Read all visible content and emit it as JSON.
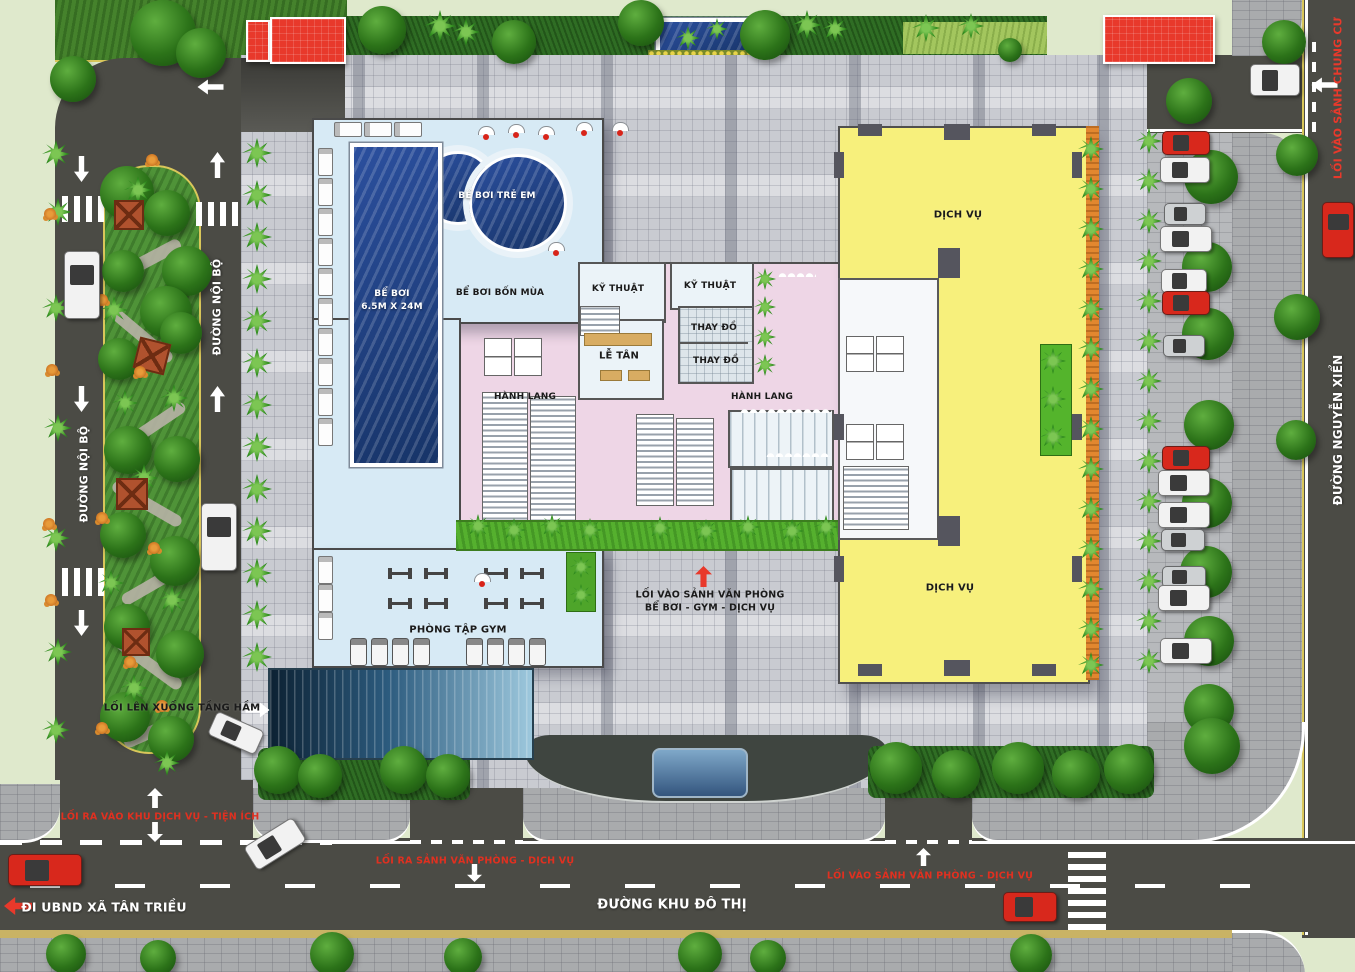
{
  "app": {
    "type": "architectural-master-site-plan",
    "project": "Tòa nhà hỗn hợp - mặt bằng tầng 1"
  },
  "colors": {
    "accent_red": "#e8392b",
    "road": "#4b4b45",
    "plaza": "#c9cbd1",
    "pool_water": "#1f3f85",
    "pool_hall": "#d7eaf5",
    "corridor_pink": "#eed6e6",
    "service_yellow": "#f7f07c",
    "green_strip": "#55b02e",
    "orange_band": "#e2872f",
    "cars": {
      "white": "#f2f2f2",
      "red": "#d8281c",
      "silver": "#ced1d3"
    }
  },
  "labels": {
    "pool_kids": "BỂ BƠI TRẺ EM",
    "pool_main_1": "BỂ BƠI",
    "pool_main_2": "6.5M X 24M",
    "pool_four_season": "BỂ BƠI BỐN MÙA",
    "technical_1": "KỸ THUẬT",
    "technical_2": "KỸ THUẬT",
    "changing_1": "THAY ĐỒ",
    "changing_2": "THAY ĐỒ",
    "reception": "LỄ TÂN",
    "corridor_1": "HÀNH LANG",
    "corridor_2": "HÀNH LANG",
    "service_1": "DỊCH VỤ",
    "service_2": "DỊCH VỤ",
    "gym": "PHÒNG TẬP GYM",
    "basement_ramp": "LỐI LÊN XUỐNG TẦNG HẦM",
    "office_entry_1": "LỐI VÀO SẢNH VĂN PHÒNG",
    "office_entry_2": "BỂ BƠI - GYM - DỊCH VỤ",
    "to_ubnd": "ĐI UBND XÃ TÂN TRIỀU",
    "urban_road": "ĐƯỜNG KHU ĐÔ THỊ",
    "internal_road_1": "ĐƯỜNG NỘI BỘ",
    "internal_road_2": "ĐƯỜNG NỘI BỘ",
    "nguyen_xien": "ĐƯỜNG NGUYỄN XIỂN",
    "apartment_entry": "LỐI VÀO SẢNH CHUNG CƯ",
    "service_gate": "LỐI RA VÀO KHU DỊCH VỤ - TIỆN ÍCH",
    "office_exit": "LỐI RA SẢNH VĂN PHÒNG - DỊCH VỤ",
    "office_gate": "LỐI VÀO SẢNH VĂN PHÒNG - DỊCH VỤ"
  },
  "decor": {
    "trees_round": [
      [
        130,
        0,
        66
      ],
      [
        176,
        28,
        50
      ],
      [
        50,
        56,
        46
      ],
      [
        358,
        6,
        48
      ],
      [
        492,
        20,
        44
      ],
      [
        618,
        0,
        46
      ],
      [
        740,
        10,
        50
      ],
      [
        998,
        38,
        24
      ],
      [
        1166,
        78,
        46
      ],
      [
        1262,
        20,
        44
      ],
      [
        1276,
        134,
        42
      ],
      [
        1274,
        294,
        46
      ],
      [
        1276,
        420,
        40
      ],
      [
        1184,
        150,
        54
      ],
      [
        1182,
        242,
        50
      ],
      [
        1182,
        308,
        52
      ],
      [
        1184,
        400,
        50
      ],
      [
        1182,
        478,
        50
      ],
      [
        1180,
        546,
        52
      ],
      [
        1184,
        616,
        50
      ],
      [
        1184,
        684,
        50
      ],
      [
        1184,
        718,
        56
      ],
      [
        870,
        742,
        52
      ],
      [
        932,
        750,
        48
      ],
      [
        992,
        742,
        52
      ],
      [
        1052,
        750,
        48
      ],
      [
        1104,
        744,
        50
      ],
      [
        254,
        746,
        48
      ],
      [
        298,
        754,
        44
      ],
      [
        380,
        746,
        48
      ],
      [
        426,
        754,
        44
      ],
      [
        46,
        934,
        40
      ],
      [
        140,
        940,
        36
      ],
      [
        310,
        932,
        44
      ],
      [
        444,
        938,
        38
      ],
      [
        678,
        932,
        44
      ],
      [
        750,
        940,
        36
      ],
      [
        1010,
        934,
        42
      ],
      [
        100,
        166,
        54
      ],
      [
        144,
        190,
        46
      ],
      [
        162,
        246,
        50
      ],
      [
        102,
        250,
        42
      ],
      [
        140,
        286,
        52
      ],
      [
        98,
        338,
        42
      ],
      [
        160,
        312,
        42
      ],
      [
        104,
        426,
        48
      ],
      [
        154,
        436,
        46
      ],
      [
        100,
        512,
        46
      ],
      [
        150,
        536,
        50
      ],
      [
        104,
        604,
        46
      ],
      [
        156,
        630,
        48
      ],
      [
        100,
        692,
        50
      ],
      [
        148,
        716,
        46
      ]
    ],
    "trees_palm": [
      [
        42,
        140,
        28
      ],
      [
        44,
        198,
        28
      ],
      [
        42,
        294,
        28
      ],
      [
        44,
        414,
        28
      ],
      [
        42,
        524,
        28
      ],
      [
        44,
        638,
        28
      ],
      [
        42,
        716,
        28
      ],
      [
        424,
        10,
        32
      ],
      [
        452,
        18,
        28
      ],
      [
        792,
        10,
        30
      ],
      [
        822,
        16,
        26
      ],
      [
        912,
        14,
        28
      ],
      [
        958,
        13,
        26
      ],
      [
        676,
        26,
        24
      ],
      [
        706,
        18,
        22
      ],
      [
        124,
        176,
        28
      ],
      [
        100,
        296,
        28
      ],
      [
        160,
        384,
        28
      ],
      [
        112,
        390,
        26
      ],
      [
        130,
        464,
        28
      ],
      [
        98,
        570,
        26
      ],
      [
        158,
        586,
        28
      ],
      [
        120,
        674,
        28
      ],
      [
        154,
        750,
        26
      ],
      [
        242,
        138,
        30
      ],
      [
        242,
        180,
        30
      ],
      [
        242,
        222,
        30
      ],
      [
        242,
        264,
        30
      ],
      [
        242,
        306,
        30
      ],
      [
        242,
        348,
        30
      ],
      [
        242,
        390,
        30
      ],
      [
        242,
        432,
        30
      ],
      [
        242,
        474,
        30
      ],
      [
        242,
        516,
        30
      ],
      [
        242,
        558,
        30
      ],
      [
        242,
        600,
        30
      ],
      [
        242,
        642,
        30
      ],
      [
        1078,
        136,
        26
      ],
      [
        1078,
        176,
        26
      ],
      [
        1078,
        216,
        26
      ],
      [
        1078,
        256,
        26
      ],
      [
        1078,
        296,
        26
      ],
      [
        1078,
        336,
        26
      ],
      [
        1078,
        376,
        26
      ],
      [
        1078,
        416,
        26
      ],
      [
        1078,
        456,
        26
      ],
      [
        1078,
        496,
        26
      ],
      [
        1078,
        536,
        26
      ],
      [
        1078,
        576,
        26
      ],
      [
        1078,
        616,
        26
      ],
      [
        1078,
        652,
        26
      ],
      [
        1136,
        128,
        26
      ],
      [
        1136,
        168,
        26
      ],
      [
        1136,
        208,
        26
      ],
      [
        1136,
        248,
        26
      ],
      [
        1136,
        288,
        26
      ],
      [
        1136,
        328,
        26
      ],
      [
        1136,
        368,
        26
      ],
      [
        1136,
        408,
        26
      ],
      [
        1136,
        448,
        26
      ],
      [
        1136,
        488,
        26
      ],
      [
        1136,
        528,
        26
      ],
      [
        1136,
        568,
        26
      ],
      [
        1136,
        608,
        26
      ],
      [
        1136,
        648,
        26
      ],
      [
        466,
        514,
        24
      ],
      [
        502,
        518,
        24
      ],
      [
        540,
        514,
        24
      ],
      [
        578,
        518,
        24
      ],
      [
        648,
        516,
        24
      ],
      [
        694,
        519,
        24
      ],
      [
        736,
        515,
        24
      ],
      [
        780,
        519,
        24
      ],
      [
        814,
        515,
        24
      ],
      [
        570,
        556,
        22
      ],
      [
        570,
        584,
        22
      ],
      [
        754,
        268,
        22
      ],
      [
        754,
        296,
        22
      ],
      [
        754,
        326,
        22
      ],
      [
        754,
        354,
        22
      ],
      [
        1040,
        348,
        26
      ],
      [
        1040,
        386,
        26
      ],
      [
        1040,
        424,
        26
      ]
    ],
    "cars": [
      [
        64,
        251,
        34,
        66,
        "white",
        0
      ],
      [
        201,
        503,
        34,
        66,
        "white",
        0
      ],
      [
        1250,
        64,
        48,
        30,
        "white",
        0
      ],
      [
        1322,
        202,
        30,
        54,
        "red",
        0
      ],
      [
        8,
        854,
        72,
        30,
        "red",
        0
      ],
      [
        246,
        830,
        56,
        26,
        "white",
        -32
      ],
      [
        1003,
        892,
        52,
        28,
        "red",
        0
      ],
      [
        210,
        720,
        50,
        24,
        "white",
        24
      ],
      [
        1162,
        131,
        46,
        22,
        "red",
        0
      ],
      [
        1160,
        157,
        48,
        24,
        "white",
        0
      ],
      [
        1164,
        203,
        40,
        20,
        "silver",
        0
      ],
      [
        1160,
        226,
        50,
        24,
        "white",
        0
      ],
      [
        1161,
        269,
        44,
        22,
        "white",
        0
      ],
      [
        1162,
        291,
        46,
        22,
        "red",
        0
      ],
      [
        1163,
        335,
        40,
        20,
        "silver",
        0
      ],
      [
        1162,
        446,
        46,
        22,
        "red",
        0
      ],
      [
        1158,
        470,
        50,
        24,
        "white",
        0
      ],
      [
        1158,
        502,
        50,
        24,
        "white",
        0
      ],
      [
        1161,
        529,
        42,
        20,
        "silver",
        0
      ],
      [
        1162,
        566,
        42,
        20,
        "silver",
        0
      ],
      [
        1158,
        585,
        50,
        24,
        "white",
        0
      ],
      [
        1160,
        638,
        50,
        24,
        "white",
        0
      ]
    ],
    "crosswalks": [
      [
        62,
        196,
        46,
        26,
        "v"
      ],
      [
        196,
        202,
        46,
        24,
        "v"
      ],
      [
        62,
        568,
        46,
        28,
        "v"
      ],
      [
        1068,
        846,
        38,
        84,
        "h"
      ]
    ],
    "arrows": [
      [
        210,
        152,
        15,
        26,
        0,
        "w"
      ],
      [
        210,
        386,
        15,
        26,
        0,
        "w"
      ],
      [
        74,
        156,
        15,
        26,
        180,
        "w"
      ],
      [
        74,
        386,
        15,
        26,
        180,
        "w"
      ],
      [
        74,
        610,
        15,
        26,
        180,
        "w"
      ],
      [
        147,
        788,
        16,
        20,
        0,
        "w"
      ],
      [
        147,
        822,
        16,
        20,
        180,
        "w"
      ],
      [
        467,
        864,
        15,
        18,
        180,
        "w"
      ],
      [
        916,
        848,
        15,
        18,
        0,
        "w"
      ],
      [
        695,
        566,
        17,
        21,
        0,
        "r"
      ],
      [
        203,
        74,
        15,
        26,
        270,
        "w"
      ],
      [
        1317,
        72,
        15,
        26,
        270,
        "w"
      ],
      [
        9,
        892,
        18,
        28,
        270,
        "r"
      ],
      [
        250,
        698,
        15,
        24,
        90,
        "w"
      ]
    ],
    "gazebos": [
      [
        114,
        200,
        26,
        0
      ],
      [
        136,
        340,
        28,
        14
      ],
      [
        116,
        478,
        28,
        0
      ],
      [
        122,
        628,
        24,
        0
      ]
    ],
    "flowers": [
      [
        44,
        208
      ],
      [
        46,
        364
      ],
      [
        43,
        518
      ],
      [
        45,
        594
      ],
      [
        146,
        154
      ],
      [
        96,
        294
      ],
      [
        134,
        366
      ],
      [
        96,
        512
      ],
      [
        148,
        542
      ],
      [
        124,
        656
      ],
      [
        96,
        722
      ],
      [
        156,
        700
      ]
    ],
    "umbrellas": [
      [
        478,
        126
      ],
      [
        508,
        124
      ],
      [
        538,
        126
      ],
      [
        576,
        122
      ],
      [
        612,
        122
      ],
      [
        548,
        242
      ],
      [
        474,
        573
      ]
    ],
    "loungers_v": [
      [
        318,
        148
      ],
      [
        318,
        178
      ],
      [
        318,
        208
      ],
      [
        318,
        238
      ],
      [
        318,
        268
      ],
      [
        318,
        298
      ],
      [
        318,
        328
      ],
      [
        318,
        358
      ],
      [
        318,
        388
      ],
      [
        318,
        418
      ],
      [
        318,
        556
      ],
      [
        318,
        584
      ],
      [
        318,
        612
      ]
    ],
    "loungers_h": [
      [
        334,
        122
      ],
      [
        364,
        122
      ],
      [
        394,
        122
      ]
    ],
    "treadmills": [
      [
        350,
        638
      ],
      [
        371,
        638
      ],
      [
        392,
        638
      ],
      [
        413,
        638
      ],
      [
        466,
        638
      ],
      [
        487,
        638
      ],
      [
        508,
        638
      ],
      [
        529,
        638
      ]
    ],
    "gym_equipment": [
      [
        388,
        568
      ],
      [
        424,
        568
      ],
      [
        484,
        568
      ],
      [
        520,
        568
      ],
      [
        388,
        598
      ],
      [
        424,
        598
      ],
      [
        484,
        598
      ],
      [
        520,
        598
      ]
    ],
    "columns": [
      [
        858,
        124,
        24,
        12
      ],
      [
        944,
        124,
        26,
        16
      ],
      [
        1032,
        124,
        24,
        12
      ],
      [
        834,
        152,
        10,
        26
      ],
      [
        834,
        414,
        10,
        26
      ],
      [
        834,
        556,
        10,
        26
      ],
      [
        1072,
        152,
        10,
        26
      ],
      [
        1072,
        414,
        10,
        26
      ],
      [
        1072,
        556,
        10,
        26
      ],
      [
        858,
        664,
        24,
        12
      ],
      [
        944,
        660,
        26,
        16
      ],
      [
        1032,
        664,
        24,
        12
      ],
      [
        938,
        248,
        22,
        30
      ],
      [
        938,
        516,
        22,
        30
      ]
    ],
    "paths": [
      [
        108,
        186,
        58,
        13,
        35
      ],
      [
        118,
        252,
        66,
        13,
        -28
      ],
      [
        104,
        330,
        76,
        12,
        40
      ],
      [
        122,
        418,
        68,
        12,
        -34
      ],
      [
        108,
        498,
        78,
        12,
        30
      ],
      [
        118,
        578,
        70,
        12,
        -30
      ],
      [
        110,
        658,
        78,
        12,
        36
      ],
      [
        122,
        726,
        58,
        12,
        -24
      ]
    ]
  }
}
